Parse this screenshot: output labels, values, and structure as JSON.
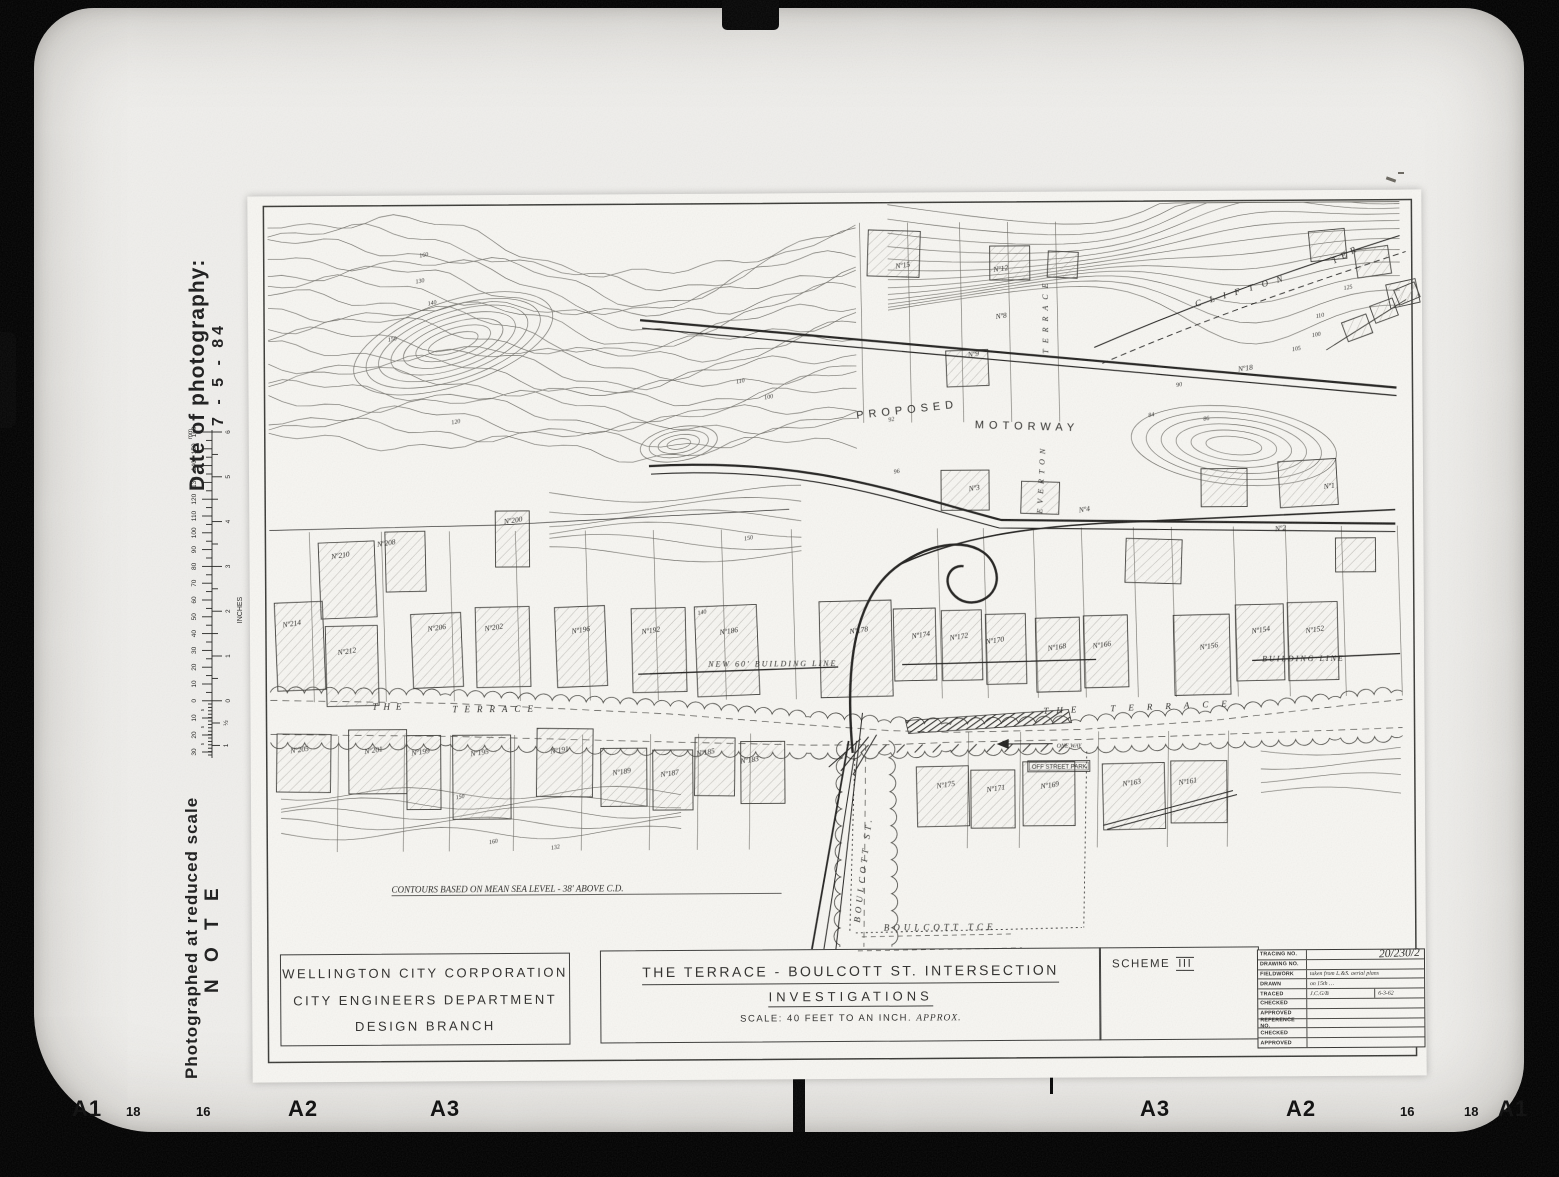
{
  "side": {
    "photo_date_label": "Date of photography:",
    "photo_date_value": "7 - 5 - 84",
    "note_line": "Photographed at reduced scale",
    "note_title": "N O T E",
    "ruler": {
      "mm_unit": "mm",
      "inch_unit": "INCHES",
      "mm_labels": [
        160,
        150,
        140,
        130,
        120,
        110,
        100,
        90,
        80,
        70,
        60,
        50,
        40,
        30,
        20,
        10,
        0
      ],
      "mm_vernier": [
        10,
        20,
        30
      ],
      "inch_labels": [
        "6",
        "5",
        "4",
        "3",
        "2",
        "1",
        "0"
      ],
      "inch_vernier": [
        "½",
        "1"
      ]
    }
  },
  "film_markers": [
    {
      "t": "A1",
      "x": 72,
      "big": 1
    },
    {
      "t": "18",
      "x": 126
    },
    {
      "t": "16",
      "x": 196
    },
    {
      "t": "A2",
      "x": 288,
      "big": 1
    },
    {
      "t": "A3",
      "x": 430,
      "big": 1
    },
    {
      "t": "A3",
      "x": 1140,
      "big": 1
    },
    {
      "t": "A2",
      "x": 1286,
      "big": 1
    },
    {
      "t": "16",
      "x": 1400
    },
    {
      "t": "18",
      "x": 1464
    },
    {
      "t": "A1",
      "x": 1498,
      "big": 1
    }
  ],
  "title_block": {
    "org_lines": [
      "WELLINGTON  CITY  CORPORATION",
      "CITY  ENGINEERS  DEPARTMENT",
      "DESIGN  BRANCH"
    ],
    "title": "THE  TERRACE  -  BOULCOTT  ST.  INTERSECTION",
    "subtitle": "INVESTIGATIONS",
    "scale_label": "SCALE: 40 FEET TO AN INCH.",
    "scale_note": "APPROX.",
    "scheme_label": "SCHEME",
    "scheme_number": "III",
    "table_rows": [
      {
        "label": "TRACING  NO.",
        "value": "",
        "big": "20/230/2"
      },
      {
        "label": "DRAWING  NO.",
        "value": ""
      },
      {
        "label": "FIELDWORK",
        "value": "taken from L.&S. aerial plans"
      },
      {
        "label": "DRAWN",
        "value": "on 15th …"
      },
      {
        "label": "TRACED",
        "value": "J.C.G/B",
        "value2": "6-3-62"
      },
      {
        "label": "CHECKED",
        "value": ""
      },
      {
        "label": "APPROVED",
        "value": ""
      },
      {
        "label": "REFERENCE NO.",
        "value": ""
      },
      {
        "label": "CHECKED",
        "value": ""
      },
      {
        "label": "APPROVED",
        "value": ""
      }
    ]
  },
  "map": {
    "labels": [
      {
        "t": "PROPOSED",
        "x": 608,
        "y": 226,
        "s": 11,
        "sp": 5,
        "r": -6
      },
      {
        "t": "MOTORWAY",
        "x": 726,
        "y": 236,
        "s": 11,
        "sp": 5,
        "r": 2
      },
      {
        "t": "THE",
        "x": 122,
        "y": 514,
        "s": 9,
        "sp": 6,
        "i": 1
      },
      {
        "t": "TERRACE",
        "x": 202,
        "y": 517,
        "s": 9,
        "sp": 7,
        "i": 1
      },
      {
        "t": "THE",
        "x": 793,
        "y": 522,
        "s": 9,
        "sp": 8,
        "i": 1,
        "r": -2
      },
      {
        "t": "TERRACE",
        "x": 860,
        "y": 520,
        "s": 9,
        "sp": 13,
        "i": 1,
        "r": -2
      },
      {
        "t": "BOULCOTT  ST.",
        "x": 608,
        "y": 730,
        "s": 9,
        "sp": 4,
        "i": 1,
        "r": -83
      },
      {
        "t": "BOULCOTT   TCE",
        "x": 632,
        "y": 738,
        "s": 9,
        "sp": 4,
        "i": 1
      },
      {
        "t": "CLIFTON",
        "x": 948,
        "y": 116,
        "s": 9,
        "sp": 9,
        "i": 1,
        "r": -16
      },
      {
        "t": "TER",
        "x": 1086,
        "y": 74,
        "s": 9,
        "sp": 5,
        "i": 1,
        "r": -28
      },
      {
        "t": "TERRACE",
        "x": 800,
        "y": 162,
        "s": 8,
        "sp": 6,
        "i": 1,
        "r": -90
      },
      {
        "t": "EVERTON",
        "x": 793,
        "y": 322,
        "s": 8,
        "sp": 5,
        "i": 1,
        "r": -87
      },
      {
        "t": "ONE WAY",
        "x": 806,
        "y": 556,
        "s": 6,
        "i": 1
      },
      {
        "t": "OFF STREET PARK",
        "x": 781,
        "y": 577,
        "s": 6,
        "box": 1
      },
      {
        "t": "NEW  60'  BUILDING  LINE",
        "x": 458,
        "y": 473,
        "s": 8,
        "sp": 2,
        "i": 1
      },
      {
        "t": "BUILDING  LINE",
        "x": 1012,
        "y": 471,
        "s": 8,
        "sp": 2,
        "i": 1
      },
      {
        "t": "CONTOURS  BASED  ON  MEAN  SEA  LEVEL  -  38' ABOVE C.D.",
        "x": 140,
        "y": 697,
        "s": 9,
        "i": 1,
        "u": 390
      }
    ],
    "house_numbers": [
      {
        "t": "Nº210",
        "x": 82,
        "y": 363
      },
      {
        "t": "Nº208",
        "x": 128,
        "y": 351
      },
      {
        "t": "Nº200",
        "x": 255,
        "y": 329
      },
      {
        "t": "Nº214",
        "x": 33,
        "y": 431
      },
      {
        "t": "Nº212",
        "x": 88,
        "y": 459
      },
      {
        "t": "Nº206",
        "x": 178,
        "y": 436
      },
      {
        "t": "Nº202",
        "x": 235,
        "y": 436
      },
      {
        "t": "Nº196",
        "x": 322,
        "y": 439
      },
      {
        "t": "Nº192",
        "x": 392,
        "y": 440
      },
      {
        "t": "Nº186",
        "x": 470,
        "y": 441
      },
      {
        "t": "Nº178",
        "x": 600,
        "y": 441
      },
      {
        "t": "Nº174",
        "x": 662,
        "y": 446
      },
      {
        "t": "Nº172",
        "x": 700,
        "y": 448
      },
      {
        "t": "Nº170",
        "x": 736,
        "y": 452
      },
      {
        "t": "Nº168",
        "x": 798,
        "y": 459
      },
      {
        "t": "Nº166",
        "x": 843,
        "y": 457
      },
      {
        "t": "Nº156",
        "x": 950,
        "y": 459
      },
      {
        "t": "Nº154",
        "x": 1002,
        "y": 443
      },
      {
        "t": "Nº152",
        "x": 1056,
        "y": 443
      },
      {
        "t": "Nº15",
        "x": 648,
        "y": 76
      },
      {
        "t": "Nº12",
        "x": 746,
        "y": 80
      },
      {
        "t": "Nº8",
        "x": 748,
        "y": 127
      },
      {
        "t": "Nº9",
        "x": 720,
        "y": 165
      },
      {
        "t": "Nº3",
        "x": 720,
        "y": 299
      },
      {
        "t": "Nº18",
        "x": 990,
        "y": 181
      },
      {
        "t": "Nº2",
        "x": 1026,
        "y": 341
      },
      {
        "t": "Nº1",
        "x": 1075,
        "y": 299
      },
      {
        "t": "Nº4",
        "x": 830,
        "y": 321
      },
      {
        "t": "Nº205",
        "x": 40,
        "y": 557
      },
      {
        "t": "Nº201",
        "x": 114,
        "y": 558
      },
      {
        "t": "Nº199",
        "x": 161,
        "y": 560
      },
      {
        "t": "Nº195",
        "x": 220,
        "y": 561
      },
      {
        "t": "Nº191",
        "x": 300,
        "y": 559
      },
      {
        "t": "Nº189",
        "x": 362,
        "y": 581
      },
      {
        "t": "Nº187",
        "x": 410,
        "y": 583
      },
      {
        "t": "Nº185",
        "x": 446,
        "y": 562
      },
      {
        "t": "Nº183",
        "x": 490,
        "y": 570
      },
      {
        "t": "Nº175",
        "x": 686,
        "y": 596
      },
      {
        "t": "Nº171",
        "x": 736,
        "y": 600
      },
      {
        "t": "Nº169",
        "x": 790,
        "y": 597
      },
      {
        "t": "Nº163",
        "x": 872,
        "y": 595
      },
      {
        "t": "Nº161",
        "x": 928,
        "y": 594
      }
    ],
    "contour_values": [
      {
        "t": "130",
        "x": 168,
        "y": 88
      },
      {
        "t": "140",
        "x": 180,
        "y": 110
      },
      {
        "t": "150",
        "x": 140,
        "y": 146
      },
      {
        "t": "160",
        "x": 172,
        "y": 62
      },
      {
        "t": "120",
        "x": 203,
        "y": 229
      },
      {
        "t": "110",
        "x": 488,
        "y": 190
      },
      {
        "t": "100",
        "x": 516,
        "y": 206
      },
      {
        "t": "96",
        "x": 645,
        "y": 281
      },
      {
        "t": "92",
        "x": 640,
        "y": 229
      },
      {
        "t": "90",
        "x": 928,
        "y": 196
      },
      {
        "t": "84",
        "x": 900,
        "y": 226
      },
      {
        "t": "86",
        "x": 955,
        "y": 230
      },
      {
        "t": "150",
        "x": 495,
        "y": 347
      },
      {
        "t": "140",
        "x": 448,
        "y": 421
      },
      {
        "t": "125",
        "x": 1096,
        "y": 100
      },
      {
        "t": "110",
        "x": 1068,
        "y": 128
      },
      {
        "t": "100",
        "x": 1064,
        "y": 147
      },
      {
        "t": "105",
        "x": 1044,
        "y": 161
      },
      {
        "t": "150",
        "x": 205,
        "y": 604
      },
      {
        "t": "160",
        "x": 238,
        "y": 649
      },
      {
        "t": "132",
        "x": 300,
        "y": 655
      }
    ],
    "buildings": [
      [
        70,
        346,
        56,
        76,
        -2
      ],
      [
        136,
        336,
        40,
        60,
        -1
      ],
      [
        246,
        316,
        34,
        56,
        0
      ],
      [
        26,
        406,
        48,
        88,
        -2
      ],
      [
        76,
        430,
        52,
        80,
        -1
      ],
      [
        162,
        418,
        50,
        74,
        -2
      ],
      [
        226,
        412,
        54,
        80,
        -1
      ],
      [
        306,
        412,
        50,
        80,
        -2
      ],
      [
        382,
        414,
        54,
        84,
        -1
      ],
      [
        446,
        412,
        62,
        90,
        -2
      ],
      [
        570,
        408,
        72,
        96,
        -1
      ],
      [
        644,
        416,
        42,
        72,
        -1
      ],
      [
        692,
        418,
        40,
        70,
        -1
      ],
      [
        736,
        422,
        40,
        70,
        -1
      ],
      [
        786,
        426,
        44,
        74,
        -1
      ],
      [
        834,
        424,
        44,
        72,
        -1
      ],
      [
        924,
        424,
        56,
        80,
        -1
      ],
      [
        986,
        414,
        48,
        76,
        -1
      ],
      [
        1038,
        412,
        50,
        78,
        -1
      ],
      [
        620,
        38,
        52,
        46,
        2
      ],
      [
        742,
        54,
        40,
        34,
        0
      ],
      [
        800,
        60,
        30,
        26,
        3
      ],
      [
        698,
        158,
        42,
        36,
        -2
      ],
      [
        692,
        278,
        48,
        40,
        0
      ],
      [
        772,
        290,
        38,
        32,
        2
      ],
      [
        952,
        278,
        46,
        38,
        0
      ],
      [
        1030,
        270,
        58,
        46,
        -3
      ],
      [
        876,
        348,
        56,
        44,
        2
      ],
      [
        1086,
        348,
        40,
        34,
        0
      ],
      [
        1108,
        58,
        34,
        28,
        -8
      ],
      [
        1140,
        92,
        30,
        24,
        -12
      ],
      [
        1062,
        40,
        36,
        30,
        -5
      ],
      [
        26,
        538,
        54,
        58,
        1
      ],
      [
        98,
        534,
        58,
        64,
        0
      ],
      [
        156,
        540,
        34,
        74,
        0
      ],
      [
        202,
        540,
        58,
        84,
        0
      ],
      [
        286,
        534,
        56,
        68,
        1
      ],
      [
        350,
        554,
        46,
        58,
        0
      ],
      [
        402,
        556,
        40,
        60,
        0
      ],
      [
        444,
        544,
        40,
        58,
        1
      ],
      [
        490,
        548,
        44,
        62,
        0
      ],
      [
        666,
        574,
        52,
        60,
        -1
      ],
      [
        720,
        578,
        44,
        58,
        0
      ],
      [
        772,
        570,
        52,
        64,
        0
      ],
      [
        852,
        572,
        62,
        66,
        -1
      ],
      [
        920,
        570,
        56,
        62,
        0
      ],
      [
        1096,
        128,
        26,
        20,
        -20
      ],
      [
        1124,
        112,
        24,
        18,
        -20
      ],
      [
        1148,
        96,
        22,
        16,
        -22
      ]
    ]
  }
}
